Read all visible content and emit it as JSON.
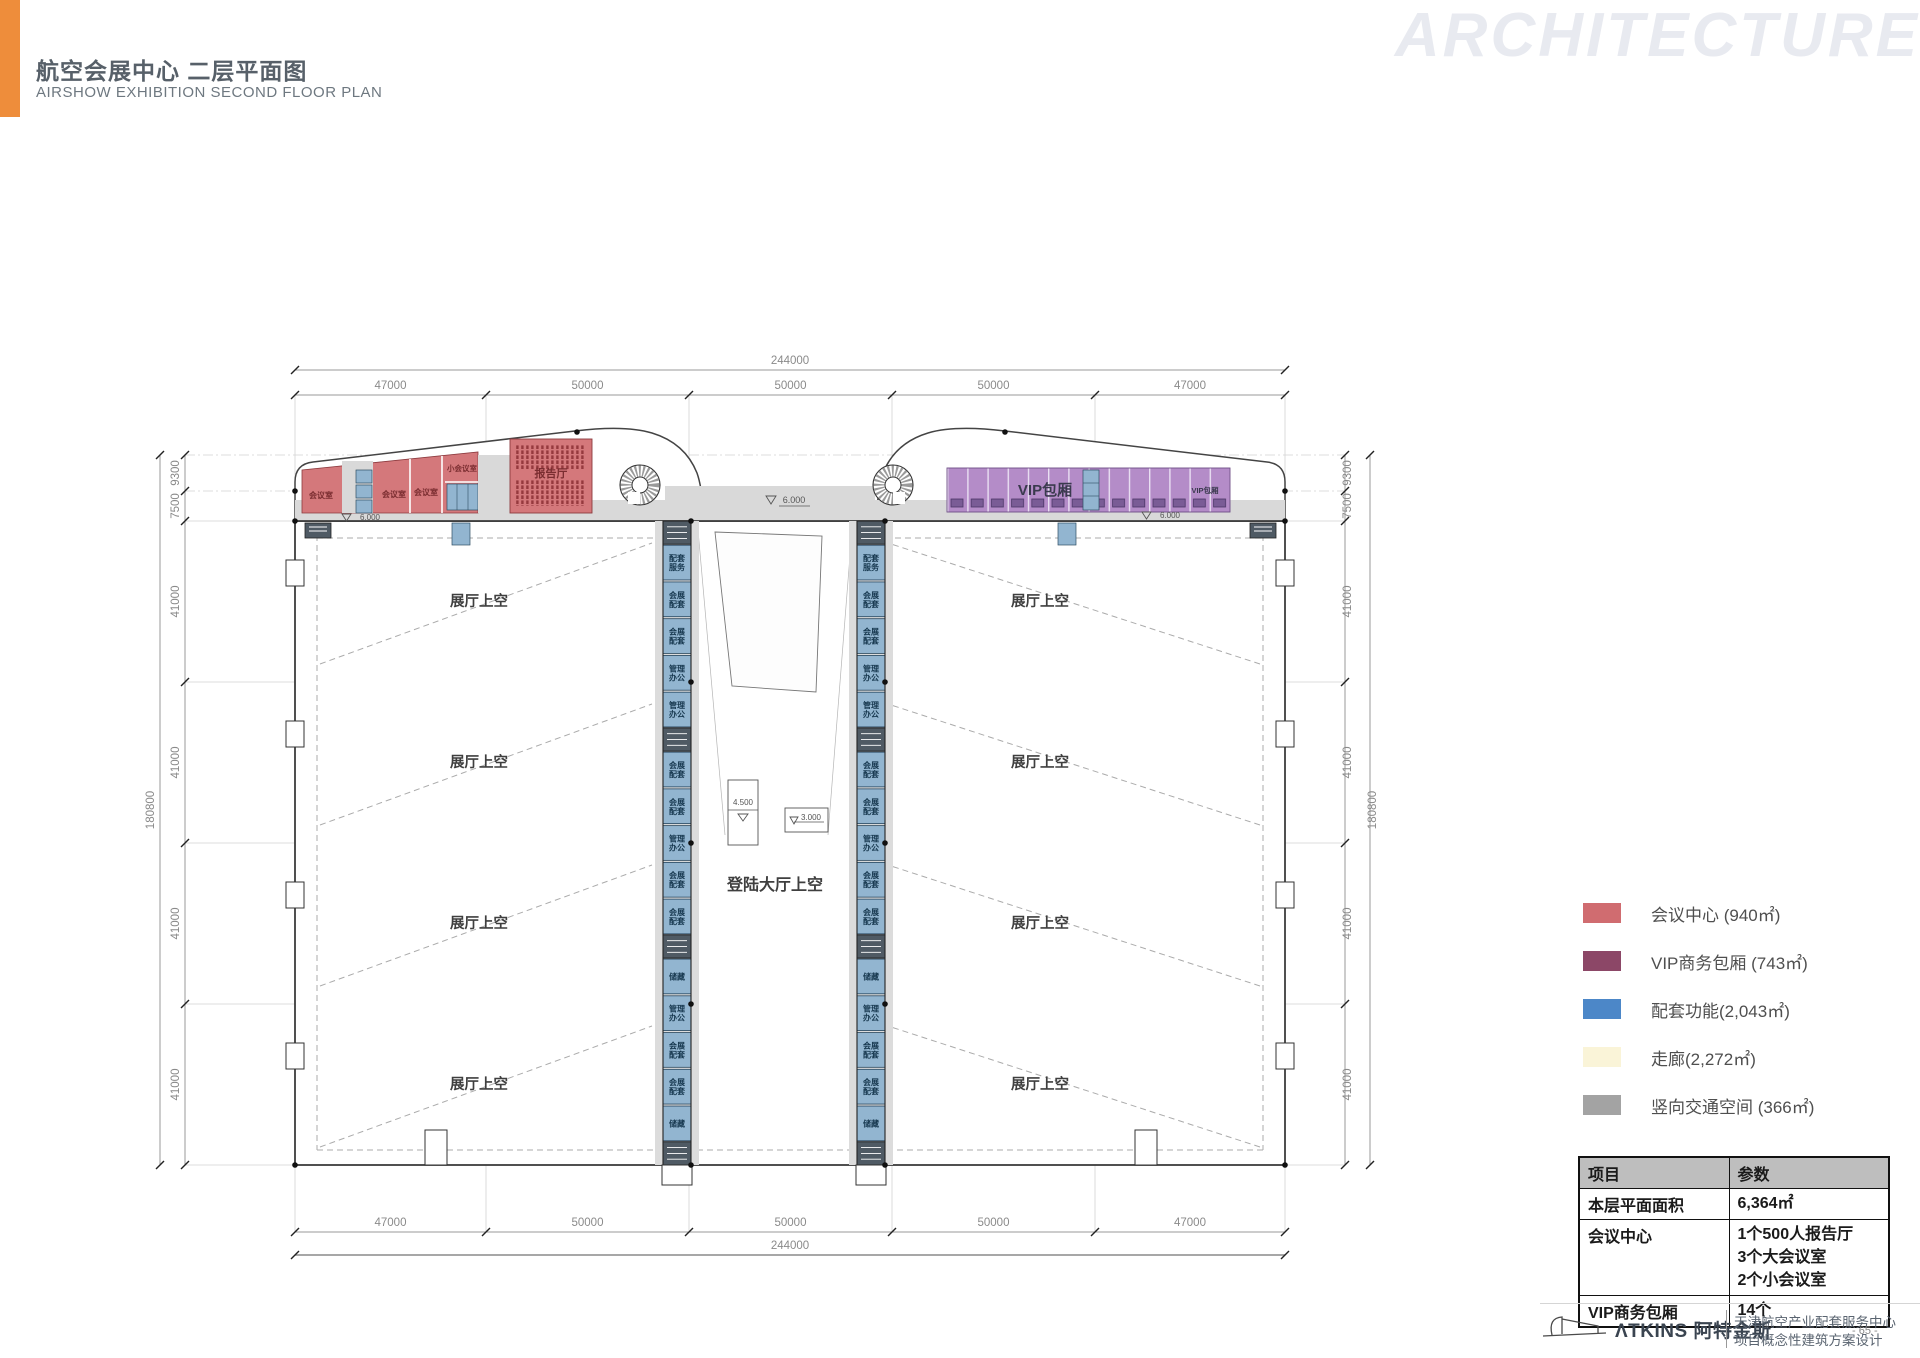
{
  "header": {
    "title_zh": "航空会展中心 二层平面图",
    "title_en": "AIRSHOW EXHIBITION SECOND FLOOR PLAN",
    "watermark": "ARCHITECTURE",
    "accent_color": "#EE8D3B"
  },
  "plan": {
    "labels": {
      "hall": "展厅上空",
      "landing": "登陆大厅上空",
      "vip_box": "VIP包厢",
      "meeting": "会议室",
      "small_meeting": "小会议室",
      "auditorium": "报告厅"
    },
    "levels": {
      "six": "6.000",
      "four_five": "4.500",
      "three": "3.000"
    },
    "dims": {
      "h_total": "244000",
      "h_segments": [
        "47000",
        "50000",
        "50000",
        "50000",
        "47000"
      ],
      "v_total": "180800",
      "v_segments": [
        "9300",
        "7500",
        "41000",
        "41000",
        "41000",
        "41000"
      ]
    },
    "core_cells": [
      {
        "type": "stair"
      },
      {
        "type": "room",
        "label": "配套服务"
      },
      {
        "type": "room",
        "label": "会展配套"
      },
      {
        "type": "room",
        "label": "会展配套"
      },
      {
        "type": "room",
        "label": "管理办公"
      },
      {
        "type": "room",
        "label": "管理办公"
      },
      {
        "type": "stair"
      },
      {
        "type": "room",
        "label": "会展配套"
      },
      {
        "type": "room",
        "label": "会展配套"
      },
      {
        "type": "room",
        "label": "管理办公"
      },
      {
        "type": "room",
        "label": "会展配套"
      },
      {
        "type": "room",
        "label": "会展配套"
      },
      {
        "type": "stair"
      },
      {
        "type": "room",
        "label": "储藏"
      },
      {
        "type": "room",
        "label": "管理办公"
      },
      {
        "type": "room",
        "label": "会展配套"
      },
      {
        "type": "room",
        "label": "会展配套"
      },
      {
        "type": "room",
        "label": "储藏"
      },
      {
        "type": "stair"
      }
    ],
    "colors": {
      "conference_red": "#D4787B",
      "vip_purple": "#B48CC8",
      "support_blue": "#92B5D0",
      "corridor_gray": "#D9D9D9"
    }
  },
  "legend": {
    "items": [
      {
        "label": "会议中心 (940㎡)",
        "color": "#D06C70"
      },
      {
        "label": "VIP商务包厢 (743㎡)",
        "color": "#8C4767"
      },
      {
        "label": "配套功能(2,043㎡)",
        "color": "#4C87C8"
      },
      {
        "label": "走廊(2,272㎡)",
        "color": "#FAF4D8"
      },
      {
        "label": "竖向交通空间 (366㎡)",
        "color": "#A3A3A3"
      }
    ]
  },
  "table": {
    "headers": [
      "项目",
      "参数"
    ],
    "rows": [
      {
        "item": "本层平面面积",
        "value": [
          "6,364㎡"
        ]
      },
      {
        "item": "会议中心",
        "value": [
          "1个500人报告厅",
          "3个大会议室",
          "2个小会议室"
        ]
      },
      {
        "item": "VIP商务包厢",
        "value": [
          "14个"
        ]
      }
    ]
  },
  "footer": {
    "brand": "ΛTKINS 阿特金斯",
    "project_line1": "天津航空产业配套服务中心",
    "project_line2": "项目概念性建筑方案设计",
    "page": "- 65 -"
  }
}
